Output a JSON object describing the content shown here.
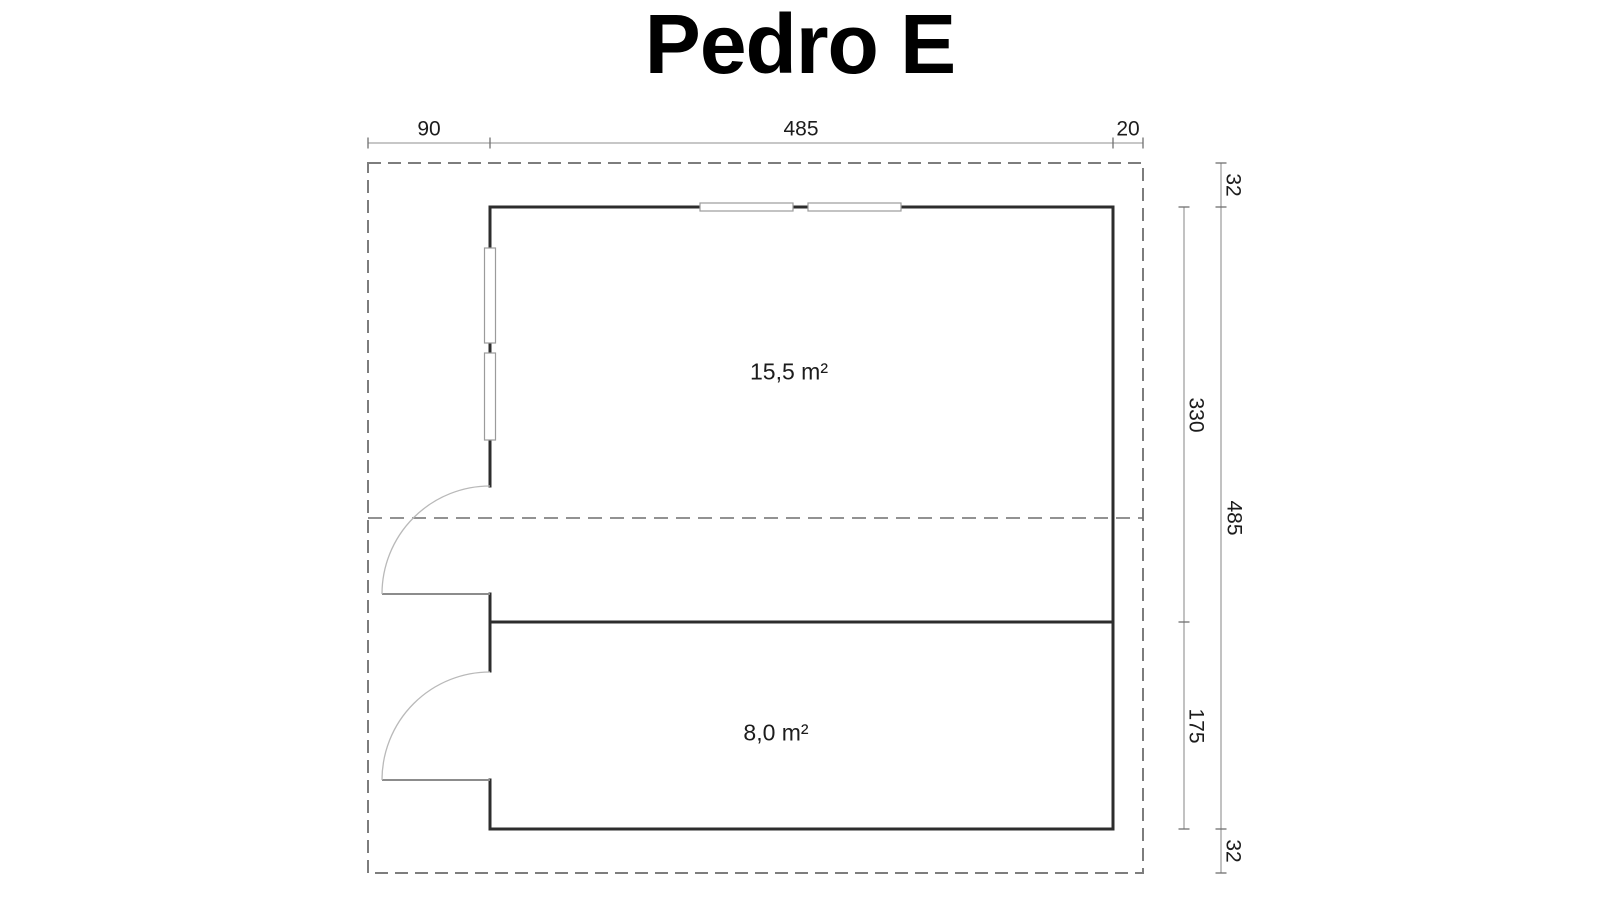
{
  "title": "Pedro E",
  "floor_plan": {
    "top_dimensions": {
      "porch_depth": "90",
      "building_width": "485",
      "right_overhang": "20"
    },
    "right_outer_dimensions": {
      "top_overhang": "32",
      "building_height": "485",
      "bottom_overhang": "32"
    },
    "right_inner_dimensions": {
      "main_room_height": "330",
      "second_room_height": "175"
    },
    "rooms": {
      "main_room_area": "15,5 m²",
      "second_room_area": "8,0 m²"
    }
  },
  "colors": {
    "background": "#ffffff",
    "wall": "#2d2d2d",
    "dash": "#7d7d7d",
    "ridge": "#6f6f6f",
    "dim_line": "#8f8f8f",
    "tick": "#707070",
    "window": "#9b9b9b",
    "door_arc": "#b9b9b9",
    "door_leaf": "#8c8c8c",
    "text": "#1c1c1c"
  }
}
